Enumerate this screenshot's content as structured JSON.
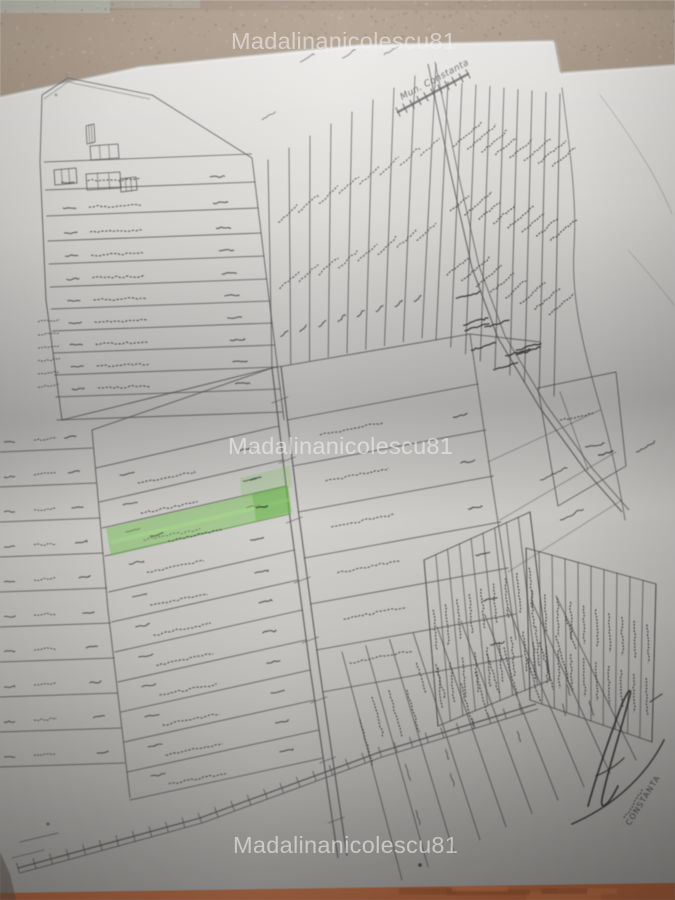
{
  "page": {
    "description": "Photograph of a hand-drawn cadastral parcel sketch map on paper, against a textured wall; one parcel strip is highlighted with green marker; handwriting on parcels is blurred and illegible"
  },
  "watermark": {
    "text": "Madalinanicolescu81",
    "color": "#f3f3f1"
  },
  "labels": {
    "road_to_constanta": "Mun. Constanta",
    "stamp_text": "CONSTANTA"
  },
  "colors": {
    "wall": "#a08c78",
    "wall_speckle_dark": "#746450",
    "wall_speckle_light": "#bfae99",
    "wall_tint_topleft": "#a9b2a4",
    "paper": "#d9d7d4",
    "pencil": "#4e4e4e",
    "ink_handwriting": "#333333",
    "highlight_green": "#72c24e",
    "highlight_green_dark": "#4ea82c",
    "table": "#b2663f"
  }
}
